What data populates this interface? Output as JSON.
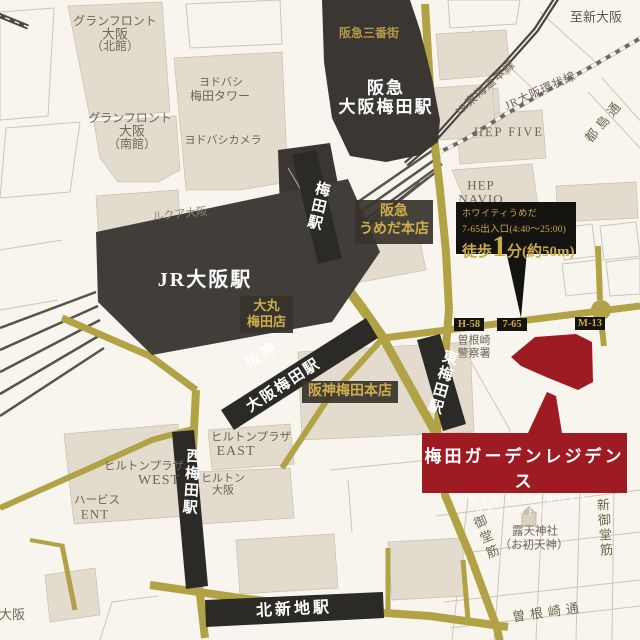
{
  "stations": {
    "hankyu_umeda": [
      "阪急",
      "大阪梅田駅"
    ],
    "jr_osaka": "JR大阪駅",
    "umeda": "梅田駅",
    "hanshin_umeda": [
      "阪神",
      "大阪梅田駅"
    ],
    "higashi_umeda": "東梅田駅",
    "nishi_umeda": "西梅田駅",
    "kitashinchi": "北新地駅"
  },
  "buildings": {
    "grand_front_north": [
      "グランフロント",
      "大阪",
      "（北館）"
    ],
    "grand_front_south": [
      "グランフロント",
      "大阪",
      "（南館）"
    ],
    "yodobashi_tower": [
      "ヨドバシ",
      "梅田タワー"
    ],
    "yodobashi_camera": "ヨドバシカメラ",
    "hankyu_sanbangai": "阪急三番街",
    "hep_five": "HEP FIVE",
    "hep_navio": [
      "HEP",
      "NAVIO"
    ],
    "lucua": "ルクア大阪",
    "hankyu_dept": [
      "阪急",
      "うめだ本店"
    ],
    "daimaru": [
      "大丸",
      "梅田店"
    ],
    "hanshin_dept": "阪神梅田本店",
    "hilton_plaza_east": [
      "ヒルトンプラザ",
      "EAST"
    ],
    "hilton_plaza_west": [
      "ヒルトンプラザ",
      "WEST"
    ],
    "hilton_osaka": [
      "ヒルトン",
      "大阪"
    ],
    "herbis_ent": [
      "ハービス",
      "ENT"
    ],
    "police": [
      "曽根崎",
      "警察署"
    ],
    "shrine": [
      "露天神社",
      "（お初天神）"
    ]
  },
  "railways": {
    "tokaido_line": "JR東海道本線",
    "loop_line": "JR大阪環状線"
  },
  "roads": {
    "midosuji": "御堂筋",
    "shin_midosuji": "新御堂筋",
    "sonezaki_dori": "曽根崎通",
    "miyakojima_dori": "都島通"
  },
  "directions": {
    "to_shin_osaka": "至新大阪",
    "to_osaka": "至大阪"
  },
  "exits": {
    "h58": "H-58",
    "e7_65": "7-65",
    "m13": "M-13"
  },
  "callout": {
    "facility": "ホワイティうめだ",
    "exit_info": "7-65出入口(4:40〜25:00)",
    "walk_prefix": "徒歩",
    "walk_minutes": "1",
    "walk_suffix": "分(約50m)"
  },
  "residence": {
    "name_ja": "梅田ガーデンレジデンス",
    "name_en_line1": "UMEDA GARDEN",
    "name_en_line2": "RESIDENCE"
  },
  "colors": {
    "accent_red": "#9e1b24",
    "road_gold": "#b1a245",
    "station_black": "#2c2a27",
    "gold_text": "#c9ab4c"
  }
}
